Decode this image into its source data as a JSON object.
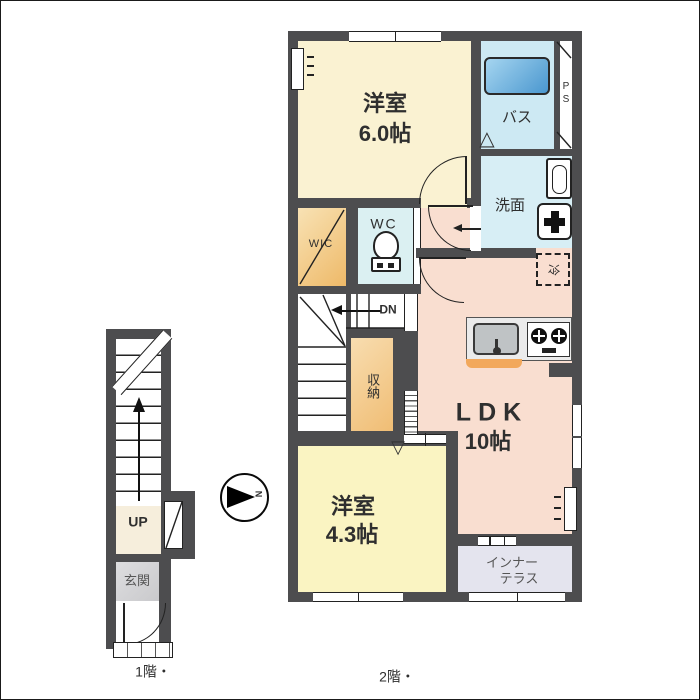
{
  "floor1": {
    "caption": "1階・",
    "up_label": "UP",
    "entrance_label": "玄関"
  },
  "floor2": {
    "caption": "2階・",
    "bedroom1": {
      "name": "洋室",
      "size": "6.0帖"
    },
    "bedroom2": {
      "name": "洋室",
      "size": "4.3帖"
    },
    "ldk": {
      "name": "LDK",
      "size": "10帖"
    },
    "bath_label": "バス",
    "ps_label": "PS",
    "washroom_label": "洗面",
    "wc_label": "WC",
    "wic_label": "WIC",
    "dn_label": "DN",
    "storage_label": "収納",
    "fridge_label": "冷",
    "terrace_label_line1": "インナー",
    "terrace_label_line2": "テラス"
  },
  "compass": {
    "north_label": "N"
  },
  "symbols": {
    "fold_door_up": "△",
    "fold_door_down": "▽"
  },
  "colors": {
    "wall": "#4D4D4F",
    "bedroom1_floor": "#FAF2D2",
    "bedroom2_floor": "#FAF4C2",
    "ldk_floor": "#F9DED0",
    "wic_floor": "#F2C27C",
    "storage_floor": "#F6CE92",
    "bath_floor": "#CDE9F3",
    "washroom_floor": "#D7EEF5",
    "wc_floor": "#DBF0F2",
    "terrace_floor": "#E4E4EE",
    "entrance_floor": "#D6D6D8",
    "up_floor": "#F6EEDC",
    "tub": "#4A97CF",
    "counter_accent": "#F2A85C"
  }
}
